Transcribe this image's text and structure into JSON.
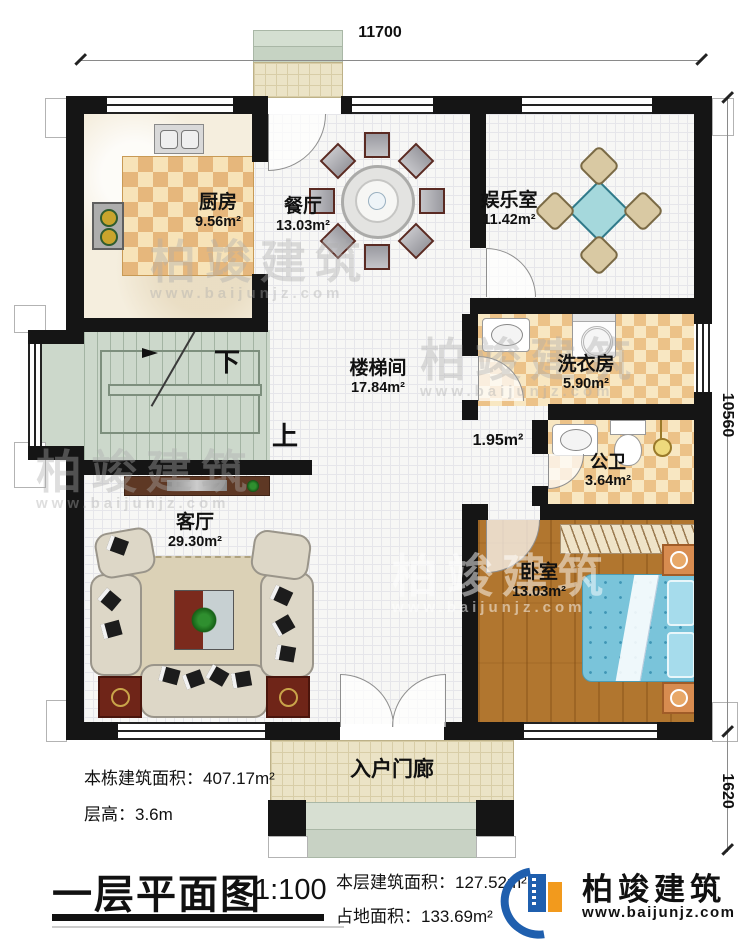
{
  "dims": {
    "top": "11700",
    "right_main": "10560",
    "right_porch": "1620"
  },
  "rooms": {
    "kitchen": {
      "name": "厨房",
      "area": "9.56m²"
    },
    "dining": {
      "name": "餐厅",
      "area": "13.03m²"
    },
    "entertainment": {
      "name": "娱乐室",
      "area": "11.42m²"
    },
    "stairwell": {
      "name": "楼梯间",
      "area": "17.84m²"
    },
    "laundry": {
      "name": "洗衣房",
      "area": "5.90m²"
    },
    "bathroom": {
      "name": "公卫",
      "area": "3.64m²"
    },
    "corridor": {
      "area": "1.95m²"
    },
    "bedroom": {
      "name": "卧室",
      "area": "13.03m²"
    },
    "living": {
      "name": "客厅",
      "area": "29.30m²"
    },
    "porch": {
      "name": "入户门廊"
    }
  },
  "stairs": {
    "down": "下",
    "up": "上"
  },
  "info": {
    "building_area_label": "本栋建筑面积：",
    "building_area": "407.17m²",
    "floor_height_label": "层高：",
    "floor_height": "3.6m",
    "floor_area_label": "本层建筑面积：",
    "floor_area": "127.52m²",
    "footprint_label": "占地面积：",
    "footprint": "133.69m²"
  },
  "title": {
    "text": "一层平面图",
    "scale": "1:100"
  },
  "brand": {
    "name": "柏竣建筑",
    "website": "www.baijunjz.com"
  },
  "watermark": {
    "text": "柏竣建筑",
    "website": "www.baijunjz.com"
  }
}
